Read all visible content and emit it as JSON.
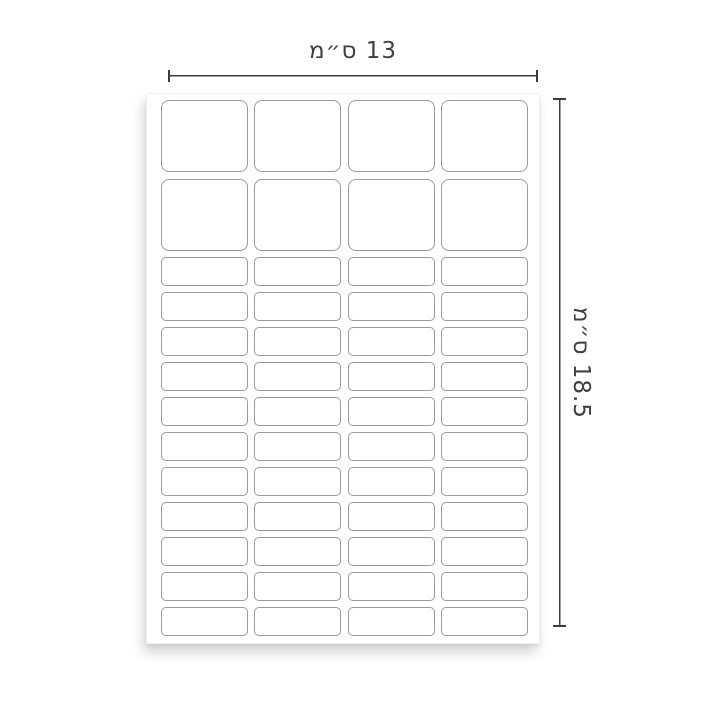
{
  "page": {
    "background": "#ffffff"
  },
  "annotations": {
    "width_dimension": {
      "label": "13 ס״מ"
    },
    "height_dimension": {
      "label": "18.5 ס״מ"
    }
  },
  "sheet": {
    "columns": 4,
    "sections": [
      {
        "name": "large-labels",
        "rows": 2,
        "labels": 8
      },
      {
        "name": "small-labels",
        "rows": 11,
        "labels": 44
      }
    ],
    "total_labels": 52
  },
  "colors": {
    "page_bg": "#ffffff",
    "sheet_bg": "#ffffff",
    "label_fill": "#ffffff",
    "label_border": "#9b9b9b",
    "dimension_line": "#3d3d3d",
    "dimension_text": "#3f3f3f"
  }
}
